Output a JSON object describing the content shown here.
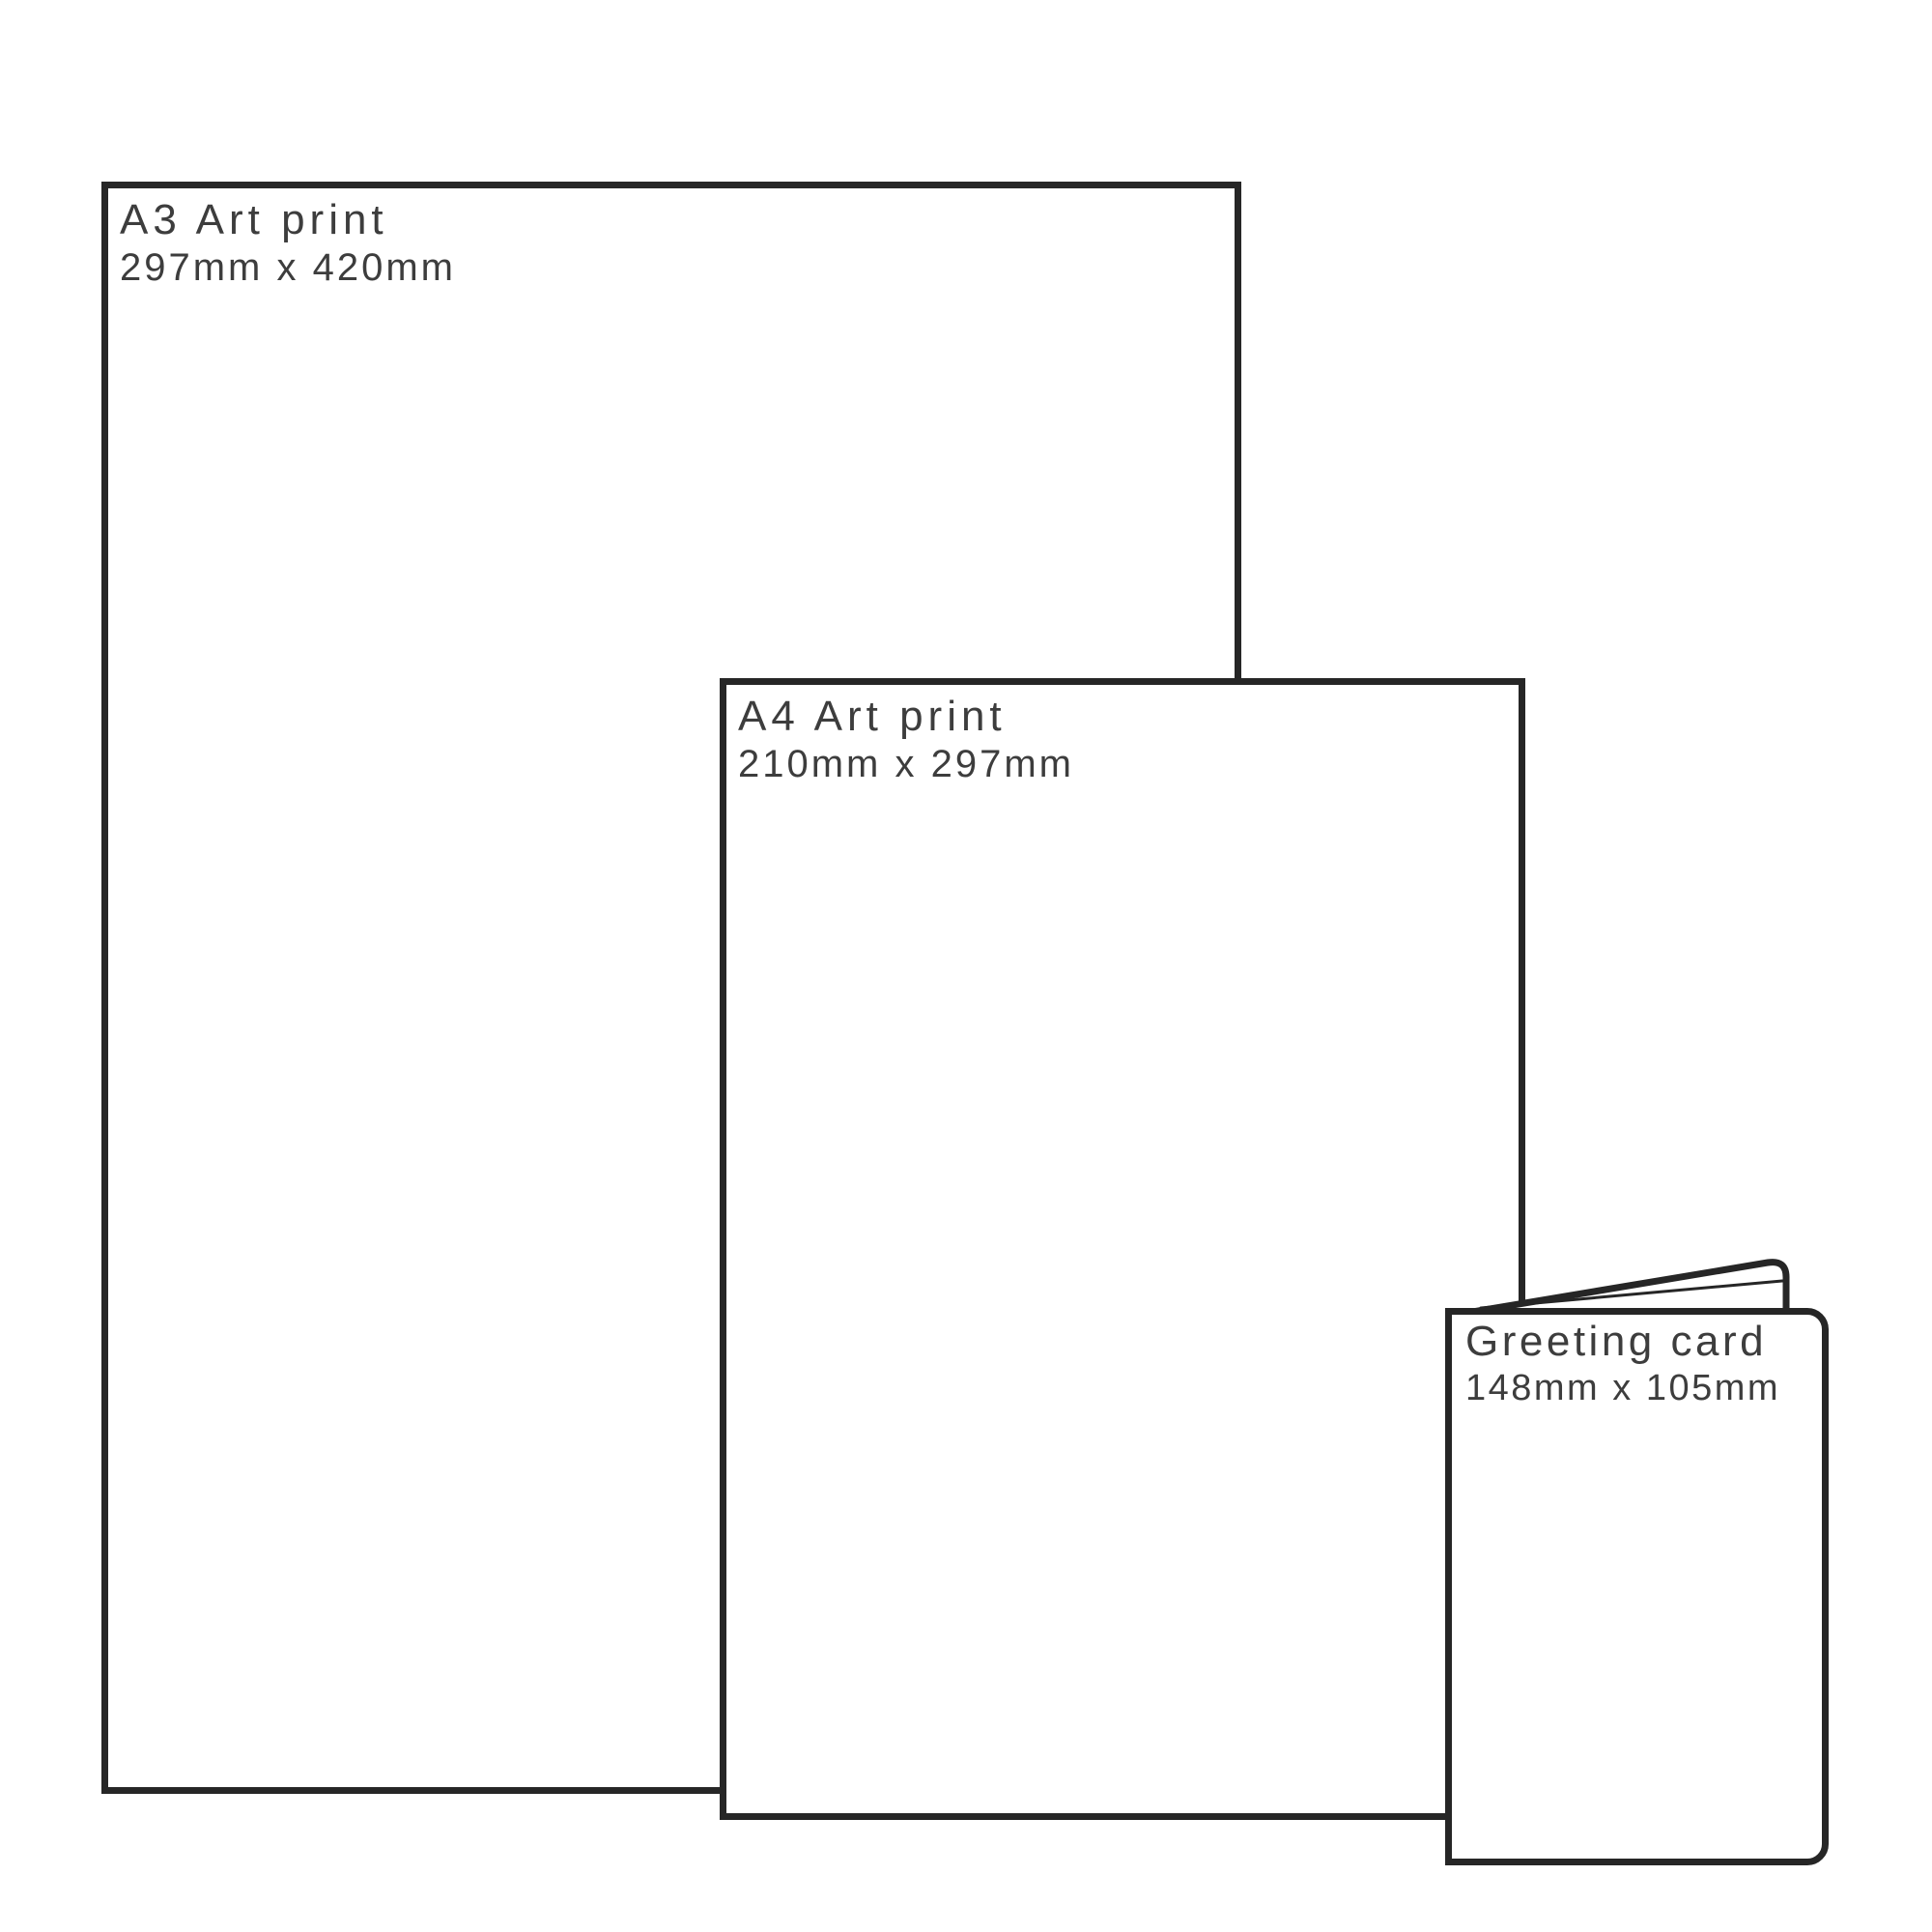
{
  "diagram": {
    "description": "Print product size comparison",
    "background_color": "#ffffff",
    "outline_color": "#262626",
    "text_color": "#3d3d3d",
    "items": [
      {
        "id": "a3-print",
        "title": "A3 Art print",
        "dimensions": "297mm x 420mm"
      },
      {
        "id": "a4-print",
        "title": "A4 Art print",
        "dimensions": "210mm x 297mm"
      },
      {
        "id": "greeting-card",
        "title": "Greeting card",
        "dimensions": "148mm x 105mm"
      }
    ]
  }
}
